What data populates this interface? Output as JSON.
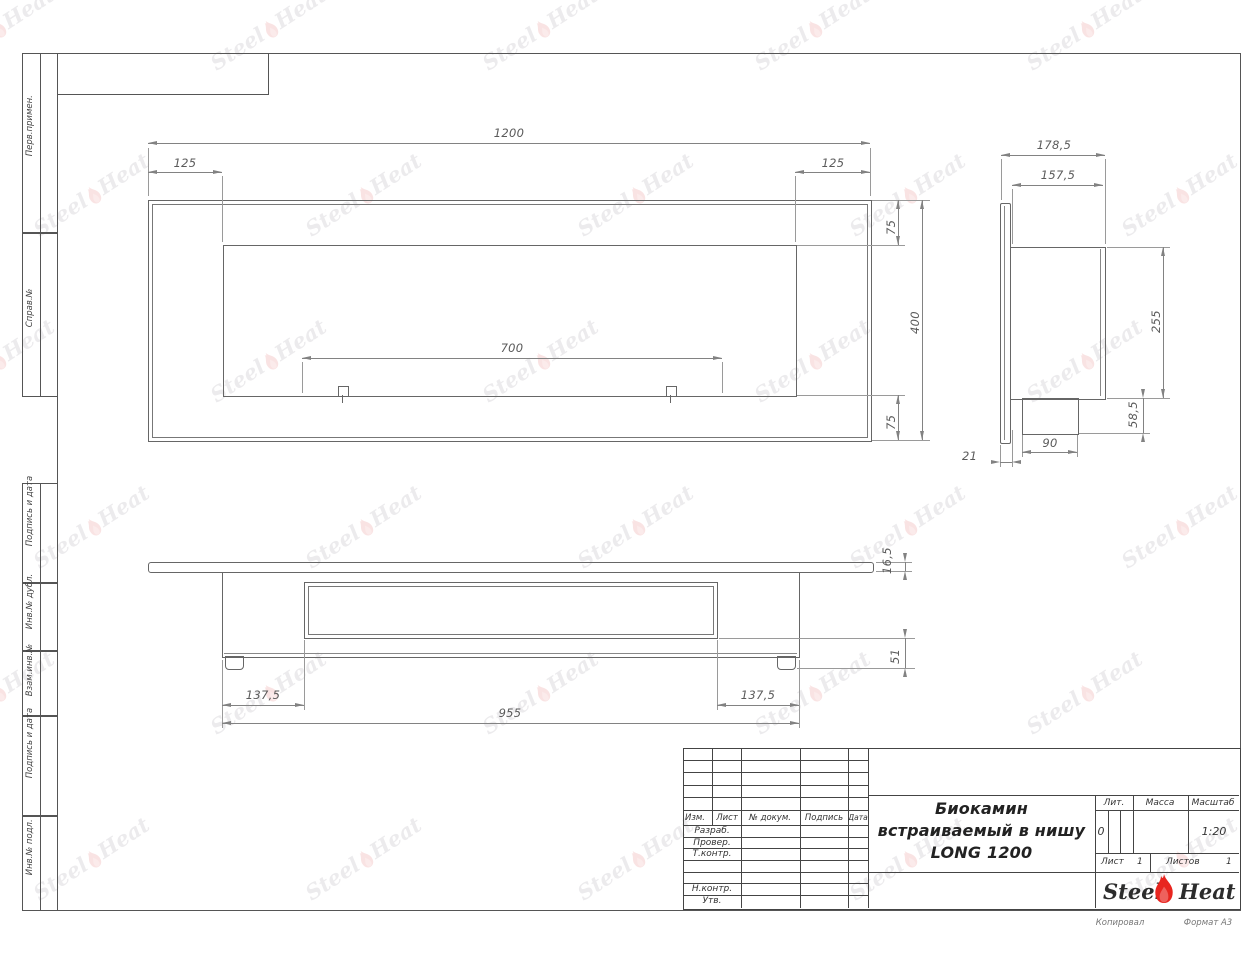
{
  "drawing_title": {
    "line1": "Биокамин",
    "line2": "встраиваемый в нишу",
    "line3": "LONG 1200"
  },
  "dims": {
    "front_width": "1200",
    "front_left_offset": "125",
    "front_right_offset": "125",
    "front_top_border": "75",
    "front_height": "400",
    "front_bottom_border": "75",
    "front_burner_length": "700",
    "side_depth_total": "178,5",
    "side_depth_body": "157,5",
    "side_body_height": "255",
    "side_box_height": "58,5",
    "side_box_width": "90",
    "side_flange_offset": "21",
    "bottom_plate_thickness": "16,5",
    "bottom_base_height": "51",
    "bottom_left_offset": "137,5",
    "bottom_right_offset": "137,5",
    "bottom_body_width": "955"
  },
  "margin_labels": {
    "perv_primen": "Перв.примен.",
    "sprav_no": "Справ.№",
    "podpis_data_1": "Подпись и дата",
    "inv_dubl": "Инв.№ дубл.",
    "vzam_inv": "Взам.инв.№",
    "podpis_data_2": "Подпись и дата",
    "inv_podl": "Инв.№ подл."
  },
  "title_block": {
    "col_izm": "Изм.",
    "col_list": "Лист",
    "col_doc": "№ докум.",
    "col_podpis": "Подпись",
    "col_data": "Дата",
    "row_razrab": "Разраб.",
    "row_prover": "Провер.",
    "row_tkontr": "Т.контр.",
    "row_nkontr": "Н.контр.",
    "row_utv": "Утв.",
    "lit_label": "Лит.",
    "lit_value": "0",
    "mass_label": "Масса",
    "scale_label": "Масштаб",
    "scale_value": "1:20",
    "sheet_label": "Лист",
    "sheet_value": "1",
    "sheets_label": "Листов",
    "sheets_value": "1"
  },
  "logo": {
    "steel": "Steel",
    "heat": "Heat"
  },
  "footer": {
    "copied": "Копировал",
    "format": "Формат А3"
  },
  "watermark": {
    "steel": "Steel",
    "heat": "Heat"
  },
  "colors": {
    "flame_red": "#e8251f",
    "line_gray": "#666666"
  }
}
